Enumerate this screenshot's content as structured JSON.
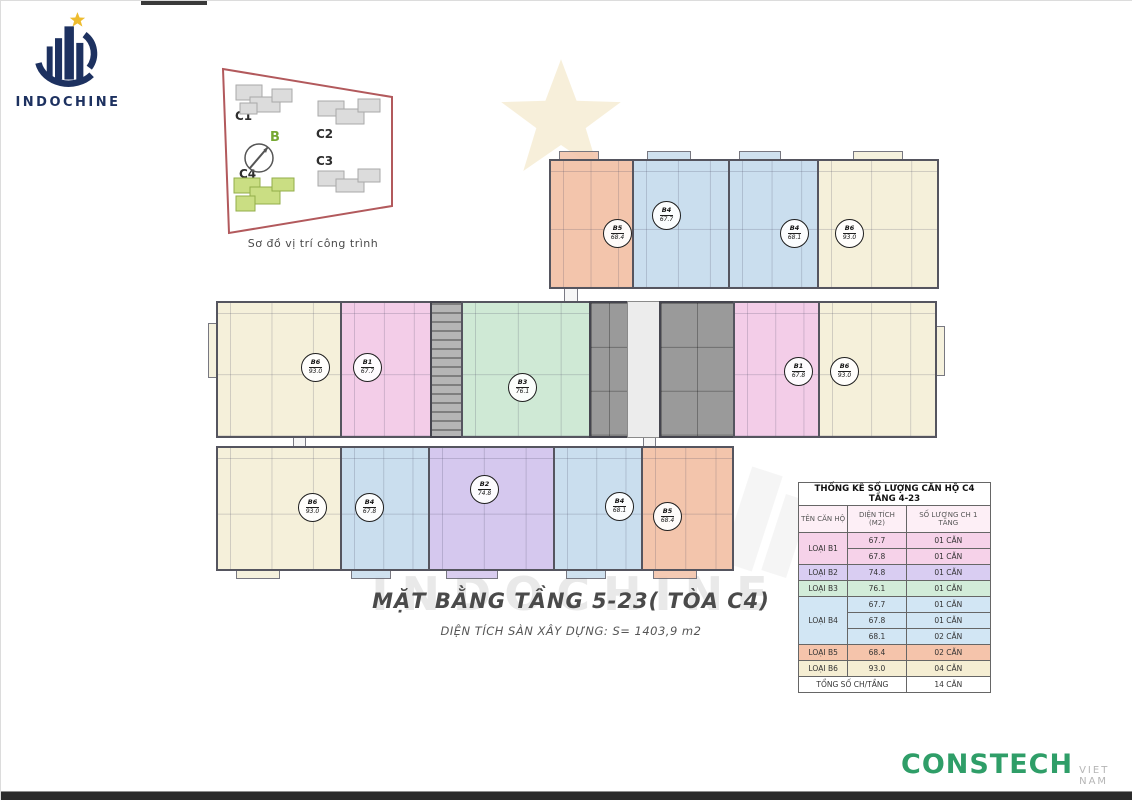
{
  "branding": {
    "logo_text": "INDOCHINE"
  },
  "location_diagram": {
    "caption": "Sơ đồ vị trí công trình",
    "compass_label": "B",
    "building_labels": [
      "C1",
      "C2",
      "C3",
      "C4"
    ],
    "highlighted_building": "C4"
  },
  "plan": {
    "title": "MẶT BẰNG TẦNG 5-23( TÒA C4)",
    "subtitle": "DIỆN TÍCH SÀN XÂY DỰNG: S= 1403,9 m2",
    "watermark": "INDOCHINE",
    "units": [
      {
        "code": "B5",
        "area": "68.4"
      },
      {
        "code": "B4",
        "area": "67.7"
      },
      {
        "code": "B4",
        "area": "68.1"
      },
      {
        "code": "B6",
        "area": "93.0"
      },
      {
        "code": "B6",
        "area": "93.0"
      },
      {
        "code": "B1",
        "area": "67.7"
      },
      {
        "code": "B3",
        "area": "76.1"
      },
      {
        "code": "B1",
        "area": "67.8"
      },
      {
        "code": "B6",
        "area": "93.0"
      },
      {
        "code": "B6",
        "area": "93.0"
      },
      {
        "code": "B4",
        "area": "67.8"
      },
      {
        "code": "B2",
        "area": "74.8"
      },
      {
        "code": "B4",
        "area": "68.1"
      },
      {
        "code": "B5",
        "area": "68.4"
      }
    ]
  },
  "table": {
    "title": "THỐNG KÊ SỐ LƯỢNG CĂN HỘ C4 TẦNG 4-23",
    "col_name": "TÊN CĂN HỘ",
    "col_area": "DIỆN TÍCH (M2)",
    "col_count": "SỐ LƯỢNG CH 1 TẦNG",
    "rows": [
      {
        "type": "LOẠI B1",
        "area": "67.7",
        "count": "01 CĂN"
      },
      {
        "area": "67.8",
        "count": "01 CĂN"
      },
      {
        "type": "LOẠI B2",
        "area": "74.8",
        "count": "01 CĂN"
      },
      {
        "type": "LOẠI B3",
        "area": "76.1",
        "count": "01 CĂN"
      },
      {
        "type": "LOẠI B4",
        "area": "67.7",
        "count": "01 CĂN"
      },
      {
        "area": "67.8",
        "count": "01 CĂN"
      },
      {
        "area": "68.1",
        "count": "02 CĂN"
      },
      {
        "type": "LOẠI B5",
        "area": "68.4",
        "count": "02 CĂN"
      },
      {
        "type": "LOẠI B6",
        "area": "93.0",
        "count": "04 CĂN"
      }
    ],
    "total_label": "TỔNG SỐ CH/TẦNG",
    "total_value": "14 CĂN"
  },
  "footer": {
    "brand": "CONSTECH",
    "region": "VIET NAM"
  },
  "colors": {
    "unit_b1_pink": "#f3cde8",
    "unit_b2_purple": "#d5c8ee",
    "unit_b3_green": "#cfe9d5",
    "unit_b4_blue": "#cadeee",
    "unit_b5_orange": "#f3c5ac",
    "unit_b6_cream": "#f5f0da",
    "core_gray": "#9a9a9a",
    "diagram_outline": "#b2595c",
    "diagram_highlight": "#cade83",
    "logo_navy": "#1d3160",
    "star_gold": "#eebc2e",
    "constech_green": "#2f9e68"
  }
}
